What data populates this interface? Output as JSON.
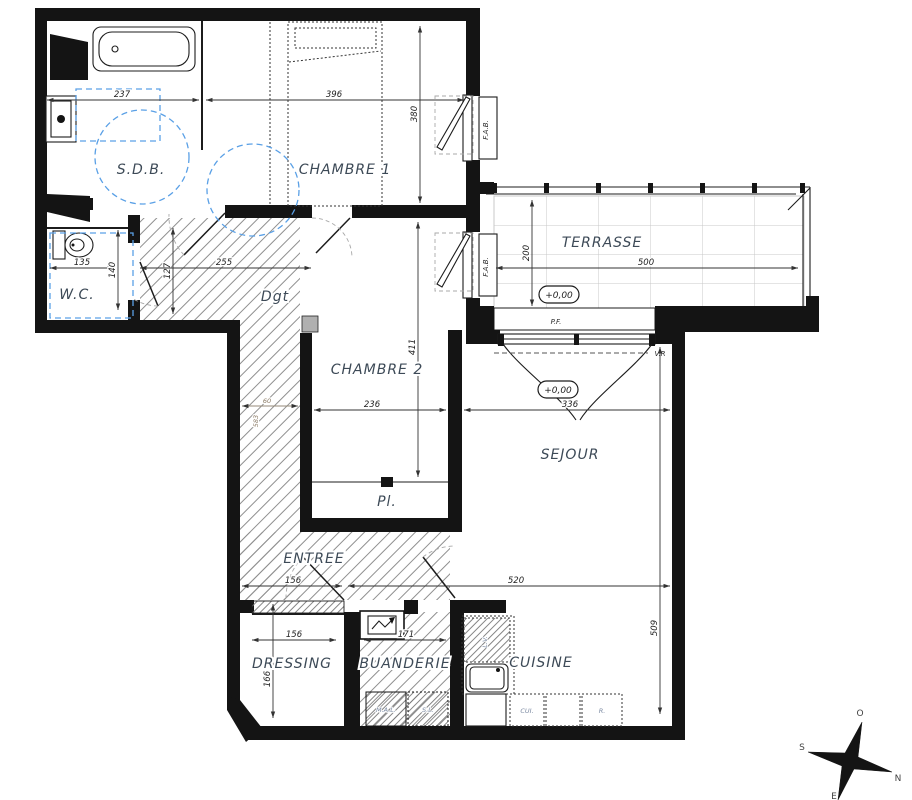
{
  "plan": {
    "rooms": {
      "sdb": "S.D.B.",
      "chambre1": "CHAMBRE 1",
      "chambre2": "CHAMBRE 2",
      "wc": "W.C.",
      "degagement": "Dgt",
      "terrasse": "TERRASSE",
      "sejour": "SEJOUR",
      "entree": "ENTREE",
      "placard": "Pl.",
      "dressing": "DRESSING",
      "buanderie": "BUANDERIE",
      "cuisine": "CUISINE"
    },
    "dimensions_cm": {
      "sdb_width": "237",
      "chambre1_width": "396",
      "chambre1_depth": "380",
      "terrasse_depth": "200",
      "terrasse_width": "500",
      "wc_width": "135",
      "wc_depth": "140",
      "hall_depth": "127",
      "hall_width": "255",
      "hall_niche_width": "60",
      "hall_niche_depth": "583",
      "chambre2_depth": "411",
      "chambre2_width": "236",
      "sejour_width": "336",
      "sejour_depth": "509",
      "sejour_total_width": "520",
      "entree_width": "156",
      "dressing_width": "156",
      "dressing_depth": "166",
      "buanderie_width": "171"
    },
    "levels": {
      "terrasse": "+0,00",
      "sejour": "+0,00"
    },
    "annotations": {
      "window": "F.A.B.",
      "french_door": "P.F.",
      "rolling_shutter": "V.R",
      "dishwasher": "L.V.",
      "cooker": "CUI.",
      "fridge": "R.",
      "washing_machine": "M.A.L.",
      "dryer": "S.L."
    },
    "compass": {
      "north": "N",
      "south": "S",
      "east": "E",
      "west": "O"
    },
    "colors": {
      "wall": "#141414",
      "hatch": "#8f8f8f",
      "tile_line": "#c9c9c9",
      "accessibility_blue": "#5aa0e6",
      "label": "#3d4a57",
      "dimension": "#222222"
    }
  }
}
